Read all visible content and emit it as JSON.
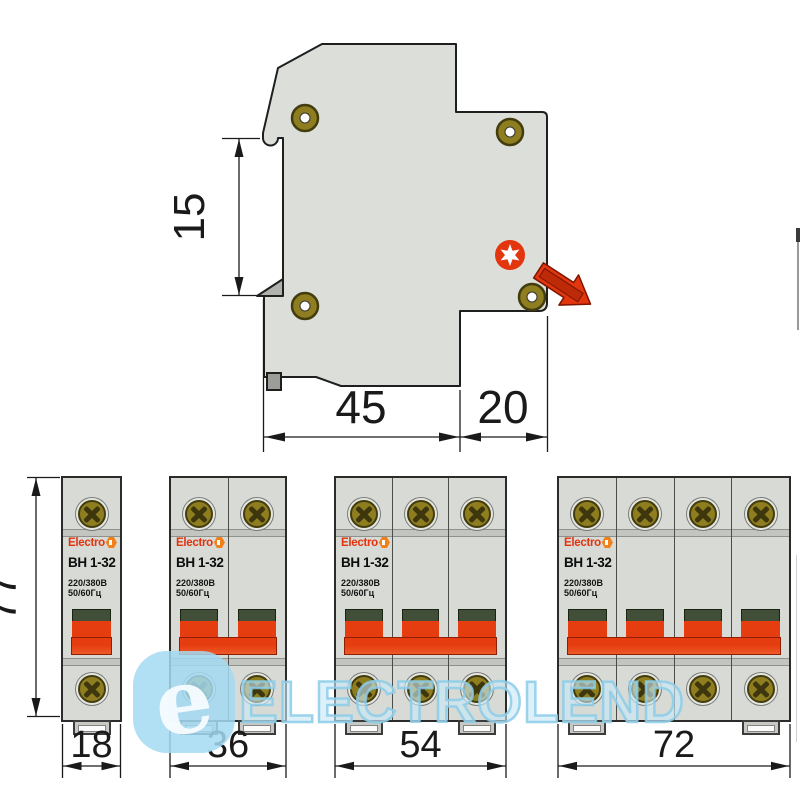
{
  "side_view": {
    "height_label": "15",
    "depth_main_label": "45",
    "depth_terminal_label": "20"
  },
  "front_view": {
    "height_label": "77",
    "breakers": [
      {
        "poles": 1,
        "width_label": "18"
      },
      {
        "poles": 2,
        "width_label": "36"
      },
      {
        "poles": 3,
        "width_label": "54"
      },
      {
        "poles": 4,
        "width_label": "72"
      }
    ]
  },
  "device_label": {
    "brand": "Electro",
    "model": "ВН 1-32",
    "voltage": "220/380В",
    "frequency": "50/60Гц"
  },
  "watermark": {
    "logo_letter": "e",
    "text": "ELECTROLEND"
  },
  "colors": {
    "body_gray": "#DCDED9",
    "toggle_red": "#E63D10",
    "toggle_cap_green": "#414F38",
    "brass_screw": "#8E7E1F",
    "logo_red": "#E2330F",
    "logo_orange": "#F08018",
    "watermark_blue": "#A3D9F2",
    "dimension_ink": "#1A1A1A"
  }
}
